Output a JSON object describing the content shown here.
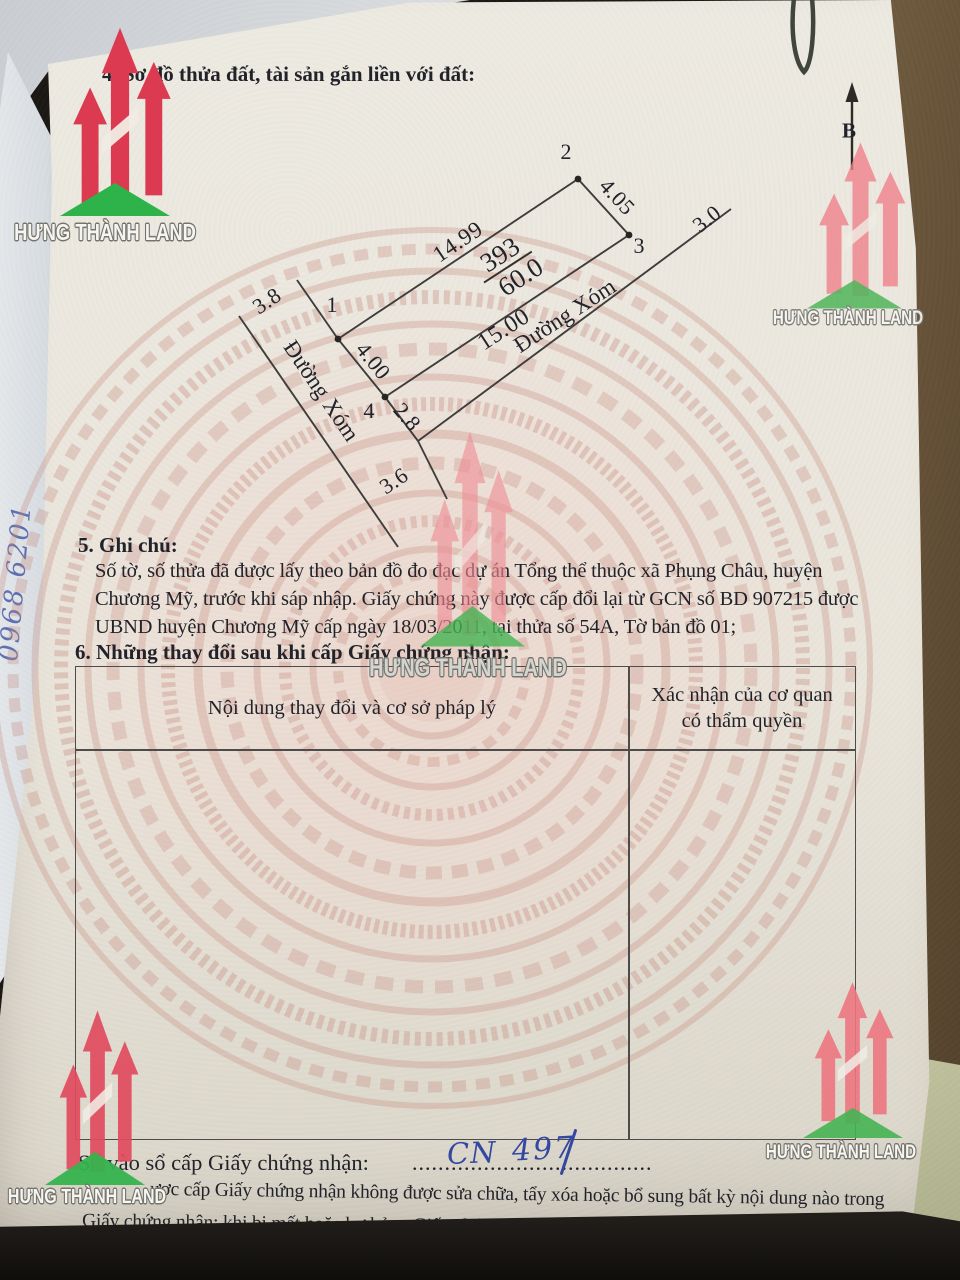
{
  "document": {
    "section4_title": "4. Sơ đồ thửa đất, tài sản gắn liền với đất:",
    "section5": {
      "title": "5. Ghi chú:",
      "lines": [
        "Số tờ, số thửa đã được lấy theo bản đồ đo đạc dự án Tổng thể thuộc xã Phụng Châu, huyện",
        "Chương Mỹ, trước khi sáp nhập. Giấy chứng này được cấp đổi lại từ GCN số BD 907215 được",
        "UBND huyện Chương Mỹ cấp ngày 18/03/2011, tại thửa số 54A, Tờ bản đồ 01;"
      ]
    },
    "section6": {
      "title": "6. Những thay đổi sau khi cấp Giấy chứng nhận:",
      "table": {
        "col1_header": "Nội dung thay đổi và cơ sở pháp lý",
        "col2_header_line1": "Xác nhận của cơ quan",
        "col2_header_line2": "có thẩm quyền"
      }
    },
    "serial": {
      "label": "Số vào sổ cấp Giấy chứng nhận:",
      "dots": "...........................................................",
      "handwritten_code": "CN",
      "handwritten_number": "497"
    },
    "footer_note": {
      "line1": "ược cấp Giấy chứng nhận không được sửa chữa, tẩy xóa hoặc bổ sung bất kỳ nội dung nào trong",
      "line2": "Giấy chứng nhận; khi bị mất hoặc hư hỏng Giấy chứng nhận phải khai báo ngay với cơ quan cấp Giấy."
    }
  },
  "diagram": {
    "north_label": "B",
    "parcel": {
      "number": "393",
      "area": "60.0"
    },
    "vertex_labels": [
      "1",
      "2",
      "3",
      "4"
    ],
    "edge_labels": {
      "top": "14.99",
      "right": "4.05",
      "bottom": "15.00",
      "left": "4.00"
    },
    "road_widths": {
      "ne": "3.0",
      "sw": "2.8",
      "west": "3.8",
      "south": "3.6"
    },
    "road_name": "Đường Xóm"
  },
  "watermark": {
    "brand": "HƯNG THÀNH LAND"
  },
  "margin_notes": {
    "handwritten_text": "Niềm Tin Chính",
    "handwritten_digits": "0968 6201"
  },
  "colors": {
    "brand_red": "#dc3a50",
    "brand_green": "#2eb34a",
    "ink_blue": "#3548a0",
    "wood_brown": "#57432c"
  }
}
